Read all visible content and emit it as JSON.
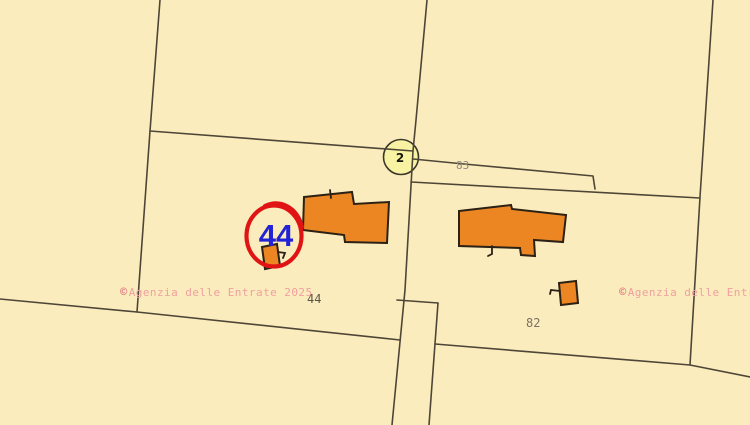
{
  "map": {
    "watermark_left": {
      "symbol": "©",
      "text": "Agenzia delle Entrate 2025"
    },
    "watermark_right": {
      "symbol": "©",
      "text": "Agenzia delle Entra"
    },
    "parcel_labels": {
      "p83": "83",
      "p44": "44",
      "p82": "82"
    },
    "road_marker": {
      "number": "2"
    },
    "highlight": {
      "parcel_number": "44"
    }
  },
  "colors": {
    "background": "#fbecbd",
    "boundary": "#4d4637",
    "building_fill": "#ec8623",
    "building_outline": "#2b2115",
    "marker_fill": "#f8f3a3",
    "highlight_red": "#e01414",
    "highlight_blue": "#2222d6",
    "watermark_pink": "#efa0a0",
    "copyright_pink": "#e28585",
    "label_gray": "#7d7166"
  }
}
